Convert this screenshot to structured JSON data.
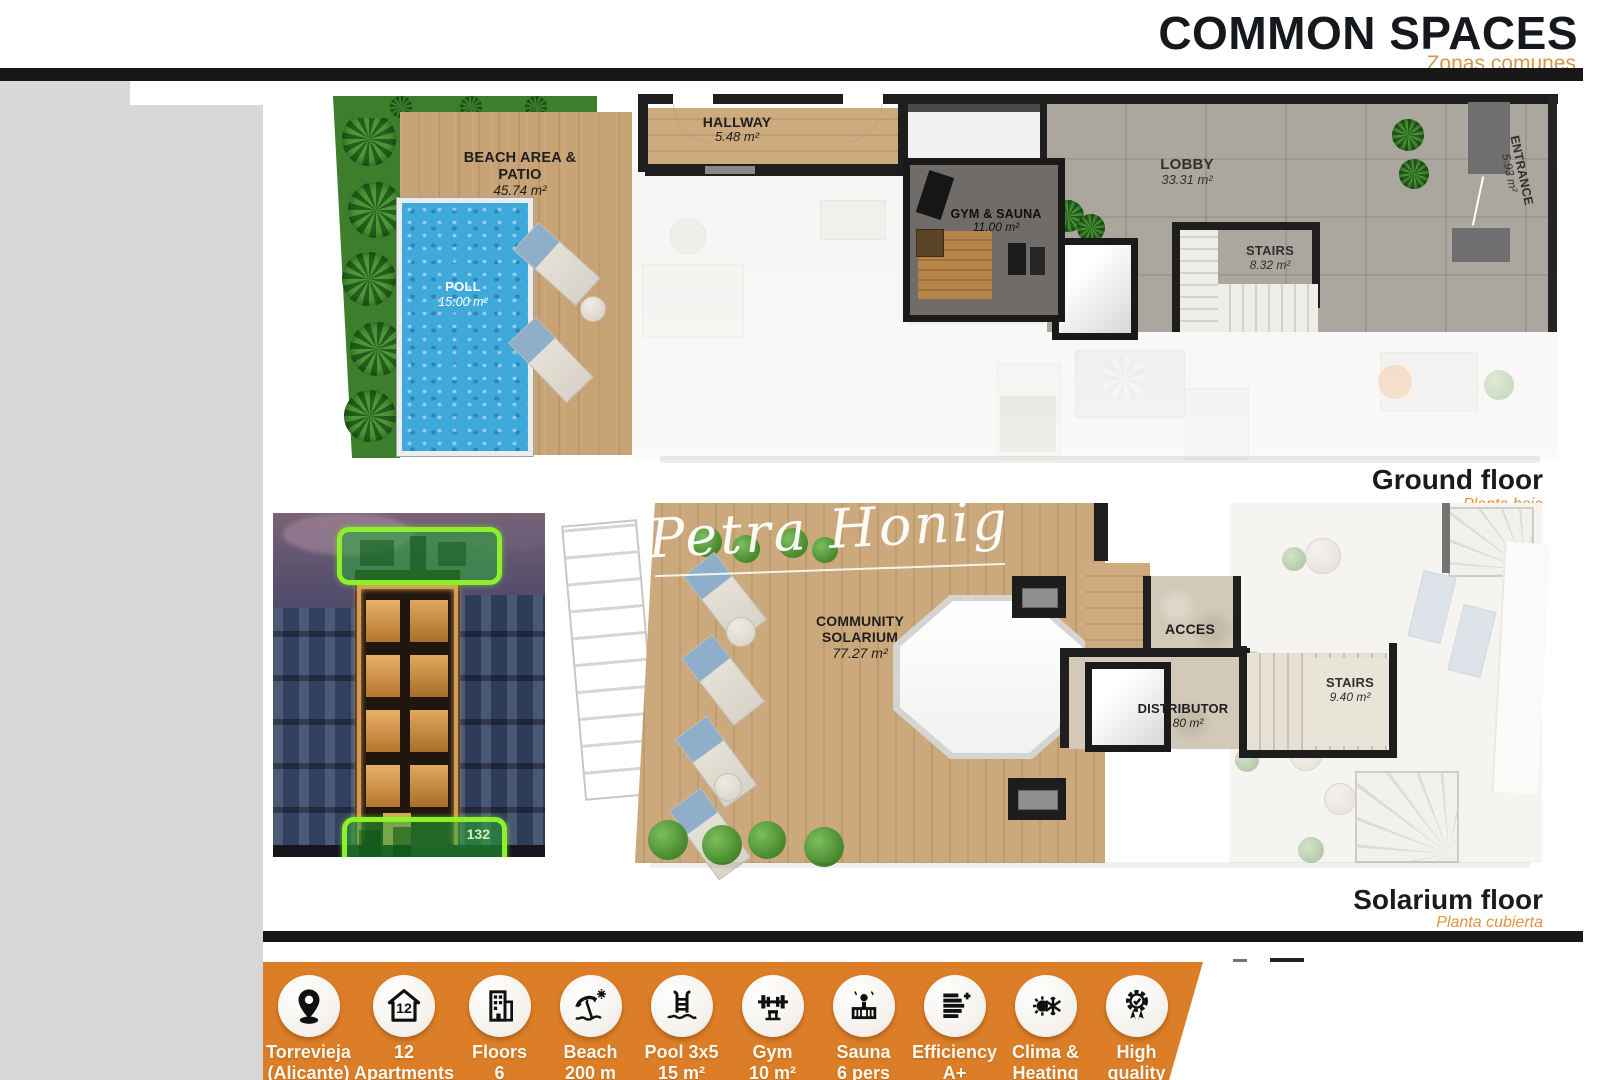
{
  "header": {
    "title": "COMMON SPACES",
    "subtitle": "Zonas comunes"
  },
  "ground_floor": {
    "caption": "Ground floor",
    "caption_es": "Planta baja",
    "rooms": [
      {
        "name": "BEACH AREA & PATIO",
        "area": "45.74 m²"
      },
      {
        "name": "POLL",
        "area": "15.00 m²"
      },
      {
        "name": "HALLWAY",
        "area": "5.48 m²"
      },
      {
        "name": "GYM & SAUNA",
        "area": "11.00 m²"
      },
      {
        "name": "LOBBY",
        "area": "33.31 m²"
      },
      {
        "name": "STAIRS",
        "area": "8.32 m²"
      },
      {
        "name": "ENTRANCE",
        "area": "5.93 m²"
      }
    ]
  },
  "solarium_floor": {
    "caption": "Solarium floor",
    "caption_es": "Planta cubierta",
    "watermark": "Petra Honig",
    "rooms": [
      {
        "name": "COMMUNITY SOLARIUM",
        "area": "77.27 m²"
      },
      {
        "name": "ACCES",
        "area": ""
      },
      {
        "name": "DISTRIBUTOR",
        "area": "7.80 m²"
      },
      {
        "name": "STAIRS",
        "area": "9.40 m²"
      }
    ]
  },
  "building_photo": {
    "badge_number": "132"
  },
  "features": [
    {
      "icon": "location-pin-icon",
      "line1": "Torrevieja",
      "line2": "(Alicante)"
    },
    {
      "icon": "house-12-icon",
      "line1": "12",
      "line2": "Apartments",
      "badge": "12"
    },
    {
      "icon": "building-icon",
      "line1": "Floors",
      "line2": "6"
    },
    {
      "icon": "beach-umbrella-icon",
      "line1": "Beach",
      "line2": "200 m"
    },
    {
      "icon": "pool-ladder-icon",
      "line1": "Pool 3x5",
      "line2": "15 m²"
    },
    {
      "icon": "barbell-icon",
      "line1": "Gym",
      "line2": "10 m²"
    },
    {
      "icon": "sauna-icon",
      "line1": "Sauna",
      "line2": "6 pers"
    },
    {
      "icon": "efficiency-icon",
      "line1": "Efficiency",
      "line2": "A+"
    },
    {
      "icon": "climate-icon",
      "line1": "Clima &",
      "line2": "Heating"
    },
    {
      "icon": "award-icon",
      "line1": "High",
      "line2": "quality"
    }
  ],
  "colors": {
    "accent_orange": "#DC7E27",
    "subtitle_orange": "#D0974E",
    "caption_orange": "#DF9440",
    "highlight_green": "#8DF02A",
    "bar_black": "#181818"
  }
}
